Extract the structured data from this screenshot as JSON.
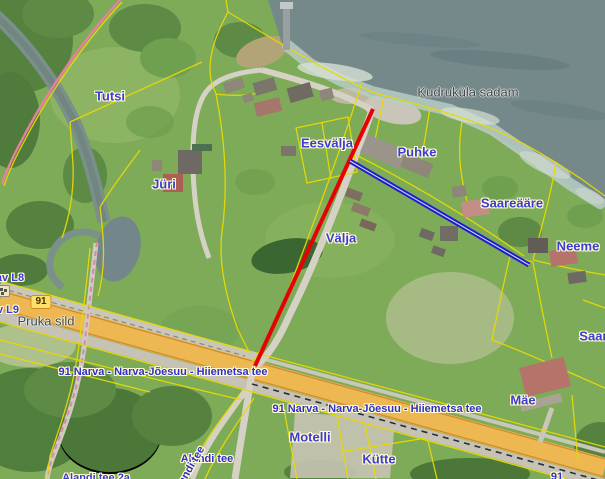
{
  "map": {
    "parcel_labels": {
      "tutsi": "Tutsi",
      "eesvalja": "Eesvälja",
      "puhke": "Puhke",
      "juri": "Jüri",
      "saareaare": "Saareääre",
      "valja": "Välja",
      "neeme": "Neeme",
      "motelli": "Motelli",
      "kutte": "Kütte",
      "mae": "Mäe",
      "saare": "Saare",
      "alandi_tee_2a": "Alandi tee 2a",
      "av_l8": "av L8",
      "v_l9": "v L9"
    },
    "place_labels": {
      "kudrukula_sadam": "Kudruküla sadam",
      "pruka_sild": "Pruka sild"
    },
    "road_labels": {
      "highway_name_west": "91 Narva - Narva-Jõesuu - Hiiemetsa tee",
      "highway_name_east": "91 Narva - Narva-Jõesuu - Hiiemetsa tee",
      "alandi_tee": "Alandi tee",
      "alandi_tee_along_road": "Alandi tee",
      "route_91_partial": "91"
    },
    "route_shield": {
      "number": "91"
    },
    "overlays": {
      "red_line": {
        "x1": 373,
        "y1": 109,
        "x2": 255,
        "y2": 366,
        "color": "#e60202"
      },
      "blue_line": {
        "x1": 350,
        "y1": 161,
        "x2": 529,
        "y2": 265,
        "color": "#1d1dcb"
      }
    },
    "colors": {
      "cadastral_boundary": "#e8d903",
      "water": "#75898b",
      "highway_fill": "#edb851",
      "label_blue": "#3c3cd2",
      "label_gray": "#41474a",
      "trail_pink": "#d884ab"
    }
  }
}
